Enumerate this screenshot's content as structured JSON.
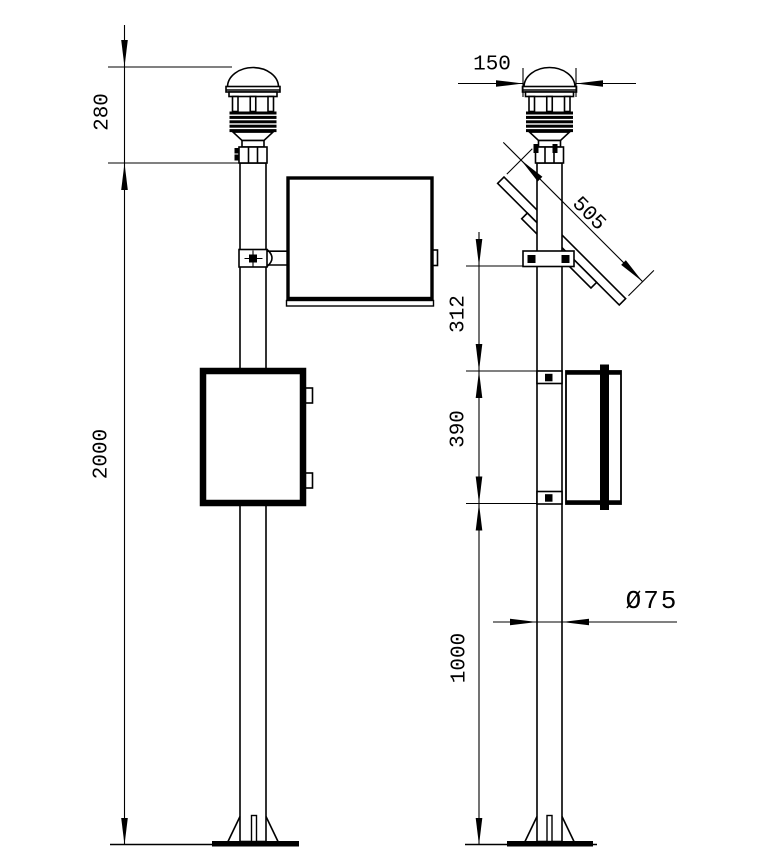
{
  "drawing": {
    "type": "technical-drawing",
    "subject": "pole-mounted weather station, front and side elevation views",
    "colors": {
      "background": "#ffffff",
      "line": "#000000"
    },
    "views": {
      "front": {
        "name": "front-view",
        "dimensions": {
          "sensor_height": "280",
          "mast_height": "2000"
        }
      },
      "side": {
        "name": "side-view",
        "dimensions": {
          "sensor_cap_width": "150",
          "solar_panel_length": "505",
          "panel_to_cabinet": "312",
          "cabinet_height": "390",
          "cabinet_to_ground": "1000",
          "pole_diameter": "Ø75"
        }
      }
    }
  }
}
